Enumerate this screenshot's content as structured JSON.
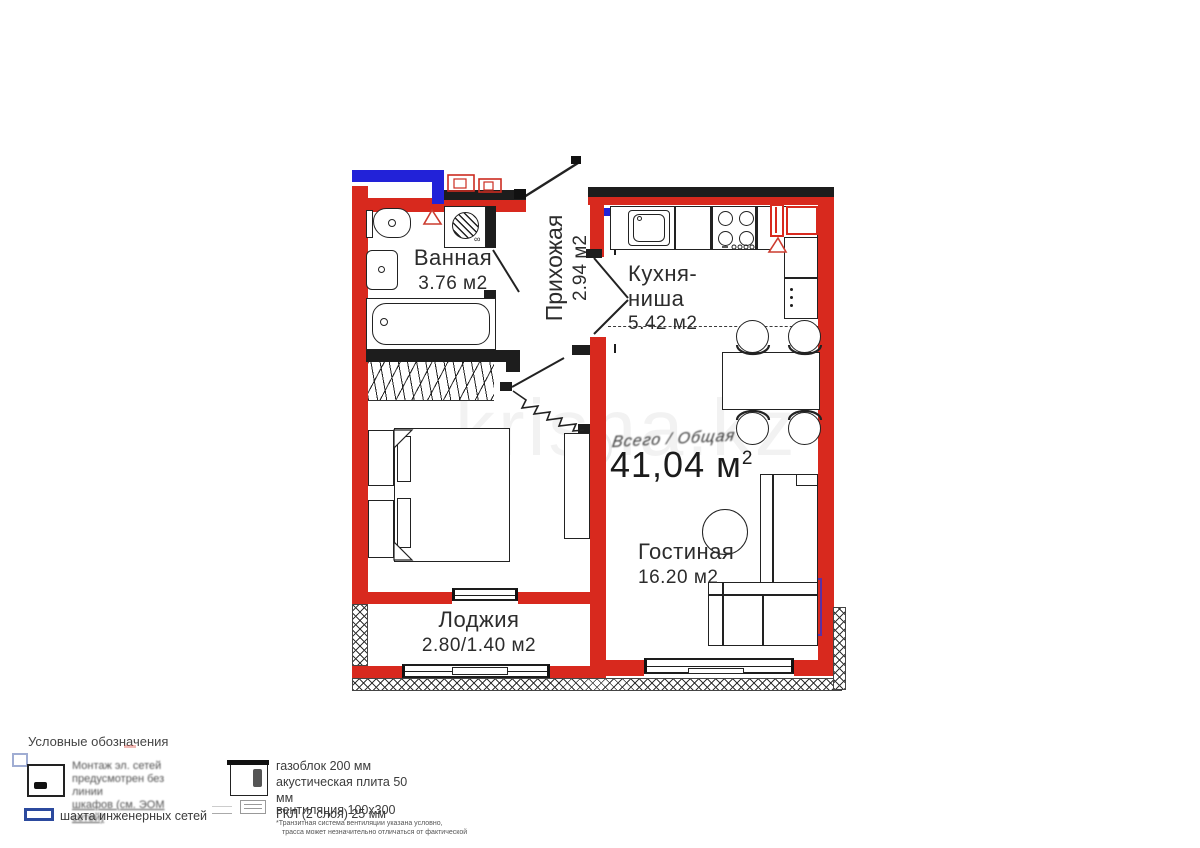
{
  "watermark": "krisha.kz",
  "plan": {
    "scribble": "Всего / Общая",
    "total": {
      "display": "41,04 м",
      "sup": "2"
    },
    "wm_mark": "∞",
    "rooms": {
      "bathroom": {
        "name": "Ванная",
        "area": "3.76 м2"
      },
      "hallway": {
        "name": "Прихожая",
        "area": "2.94 м2"
      },
      "kitchen": {
        "name": "Кухня-ниша",
        "area": "5.42 м2"
      },
      "living": {
        "name": "Гостиная",
        "area": "16.20 м2"
      },
      "loggia": {
        "name": "Лоджия",
        "area": "2.80/1.40 м2"
      }
    }
  },
  "legend": {
    "title": "Условные обозначения",
    "wiring_note_lines": [
      "Монтаж эл. сетей",
      "предусмотрен без линии",
      "шкафов (см. ЭОМ сетей)"
    ],
    "shaft_label": "шахта инженерных сетей",
    "wall_layers_lines": [
      "газоблок 200 мм",
      "акустическая плита 50 мм",
      "ГКЛ (2 слоя) 25 мм"
    ],
    "vent_label": "вентиляция 100x300",
    "vent_note_lines": [
      "*Транзитная система вентиляции указана условно,",
      "трасса может незначительно отличаться от фактической"
    ]
  },
  "colors": {
    "wall_red": "#d8291e",
    "riser_blue": "#2222d8",
    "legend_blue": "#2c4a9e",
    "ink": "#222222"
  }
}
